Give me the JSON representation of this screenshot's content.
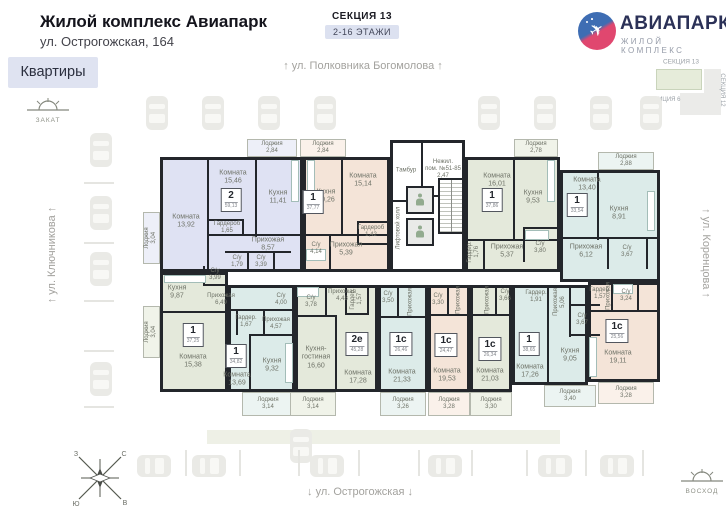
{
  "header": {
    "title": "Жилой комплекс Авиапарк",
    "address": "ул. Острогожская, 164",
    "tab_apartments": "Квартиры",
    "section": "СЕКЦИЯ 13",
    "floors": "2-16 ЭТАЖИ"
  },
  "brand": {
    "name": "АВИАПАРК",
    "subtitle": "ЖИЛОЙ КОМПЛЕКС"
  },
  "minimap": {
    "section13": "СЕКЦИЯ 13",
    "section12": "СЕКЦИЯ 12",
    "position": "ПОЗИЦИЯ 6"
  },
  "streets": {
    "top": "↑ ул. Полковника Богомолова ↑",
    "left": "↑ ул. Ключникова ↑",
    "right": "↑ ул. Коренцова ↑",
    "bottom": "↓ ул. Острогожская ↓"
  },
  "sun": {
    "sunset": "ЗАКАТ",
    "sunrise": "ВОСХОД"
  },
  "compass": {
    "n": "С",
    "e": "В",
    "s": "Ю",
    "w": "З"
  },
  "core": {
    "tambour": "Тамбур",
    "nonres1": "Нежил.",
    "nonres2": "пом. №51-85",
    "nonres3": "2,47",
    "lift_hall": "Лифтовой холл"
  },
  "colors": {
    "lavender": "#dfe2f3",
    "beige": "#f4e4d8",
    "green": "#e4e9db",
    "cyan": "#dcebe9",
    "wall": "#23262b",
    "accent": "#dfe3f1"
  },
  "apartments": {
    "a": {
      "type": "2",
      "total": "59,13",
      "rooms": {
        "living1": {
          "n": "Комната",
          "s": "15,46"
        },
        "living2": {
          "n": "Комната",
          "s": "13,92"
        },
        "kitchen": {
          "n": "Кухня",
          "s": "11,41"
        },
        "wardrobe": {
          "n": "Гардероб",
          "s": "1,65"
        },
        "hall": {
          "n": "Прихожая",
          "s": "8,57"
        },
        "bath1": {
          "n": "С/у",
          "s": "1,79"
        },
        "bath2": {
          "n": "С/у",
          "s": "3,39"
        },
        "loggia_side": {
          "n": "Лоджия",
          "s": "3,04"
        },
        "loggia_top": {
          "n": "Лоджия",
          "s": "2,84"
        }
      }
    },
    "b": {
      "type": "1",
      "total": "37,77",
      "rooms": {
        "loggia": {
          "n": "Лоджия",
          "s": "2,84"
        },
        "kitchen": {
          "n": "Кухня",
          "s": "10,26"
        },
        "living": {
          "n": "Комната",
          "s": "15,14"
        },
        "bath": {
          "n": "С/у",
          "s": "4,14"
        },
        "hall": {
          "n": "Прихожая",
          "s": "5,39"
        },
        "wardrobe": {
          "n": "Гардероб",
          "s": "1,42"
        }
      }
    },
    "c": {
      "type": "1",
      "total": "37,86",
      "rooms": {
        "living": {
          "n": "Комната",
          "s": "16,01"
        },
        "kitchen": {
          "n": "Кухня",
          "s": "9,53"
        },
        "loggia": {
          "n": "Лоджия",
          "s": "2,78"
        },
        "wardrobe": {
          "n": "Гардер.",
          "s": "1,76"
        },
        "hall": {
          "n": "Прихожая",
          "s": "5,37"
        },
        "bath": {
          "n": "С/у",
          "s": "3,80"
        }
      }
    },
    "d": {
      "type": "1",
      "total": "33,54",
      "rooms": {
        "living": {
          "n": "Комната",
          "s": "13,40"
        },
        "loggia": {
          "n": "Лоджия",
          "s": "2,88"
        },
        "kitchen": {
          "n": "Кухня",
          "s": "8,91"
        },
        "hall": {
          "n": "Прихожая",
          "s": "6,12"
        },
        "bath": {
          "n": "С/у",
          "s": "3,67"
        }
      }
    },
    "e": {
      "type": "1",
      "total": "37,25",
      "rooms": {
        "kitchen": {
          "n": "Кухня",
          "s": "9,87"
        },
        "bath": {
          "n": "С/у",
          "s": "3,99"
        },
        "hall": {
          "n": "Прихожая",
          "s": "6,49"
        },
        "loggia": {
          "n": "Лоджия",
          "s": "3,04"
        },
        "living": {
          "n": "Комната",
          "s": "15,38"
        }
      }
    },
    "f": {
      "type": "1",
      "total": "34,82",
      "rooms": {
        "wardrobe": {
          "n": "Гардер.",
          "s": "1,67"
        },
        "hall": {
          "n": "Прихожая",
          "s": "4,57"
        },
        "bath": {
          "n": "С/у",
          "s": "4,00"
        },
        "living": {
          "n": "Комната",
          "s": "13,69"
        },
        "kitchen": {
          "n": "Кухня",
          "s": "9,32"
        },
        "loggia": {
          "n": "Лоджия",
          "s": "3,14"
        }
      }
    },
    "g": {
      "type": "2е",
      "total": "45,28",
      "rooms": {
        "bath": {
          "n": "С/у",
          "s": "3,78"
        },
        "hall": {
          "n": "Прихожая",
          "s": "4,48"
        },
        "wardrobe": {
          "n": "Гардер.",
          "s": "1,57"
        },
        "kitchen_living": {
          "n": "Кухня-гостиная",
          "s": "16,60"
        },
        "living": {
          "n": "Комната",
          "s": "17,28"
        },
        "loggia": {
          "n": "Лоджия",
          "s": "3,14"
        }
      }
    },
    "h": {
      "type": "1с",
      "total": "26,46",
      "rooms": {
        "bath": {
          "n": "С/у",
          "s": "3,50"
        },
        "hall": {
          "n": "Прихожая",
          "s": ""
        },
        "living": {
          "n": "Комната",
          "s": "21,33"
        },
        "loggia": {
          "n": "Лоджия",
          "s": "3,26"
        }
      }
    },
    "i": {
      "type": "1с",
      "total": "24,47",
      "rooms": {
        "bath": {
          "n": "С/у",
          "s": "3,30"
        },
        "hall": {
          "n": "Прихожая",
          "s": ""
        },
        "living": {
          "n": "Комната",
          "s": "19,53"
        },
        "loggia": {
          "n": "Лоджия",
          "s": "3,28"
        }
      }
    },
    "l": {
      "type": "1с",
      "total": "26,34",
      "rooms": {
        "hall": {
          "n": "Прихожая",
          "s": ""
        },
        "bath": {
          "n": "С/у",
          "s": "3,66"
        },
        "living": {
          "n": "Комната",
          "s": "21,03"
        },
        "loggia": {
          "n": "Лоджия",
          "s": "3,30"
        }
      }
    },
    "j": {
      "type": "1",
      "total": "38,65",
      "rooms": {
        "wardrobe": {
          "n": "Гардер.",
          "s": "1,91"
        },
        "hall": {
          "n": "Прихожая",
          "s": "5,06"
        },
        "bath": {
          "n": "С/у",
          "s": "3,67"
        },
        "kitchen": {
          "n": "Кухня",
          "s": "9,05"
        },
        "living": {
          "n": "Комната",
          "s": "17,26"
        },
        "loggia": {
          "n": "Лоджия",
          "s": "3,40"
        }
      }
    },
    "k": {
      "type": "1с",
      "total": "25,56",
      "rooms": {
        "wardrobe": {
          "n": "Гардер.",
          "s": "1,57"
        },
        "hall": {
          "n": "Прихожая",
          "s": ""
        },
        "bath": {
          "n": "С/у",
          "s": "3,24"
        },
        "living": {
          "n": "Комната",
          "s": "19,11"
        },
        "loggia": {
          "n": "Лоджия",
          "s": "3,28"
        }
      }
    }
  }
}
